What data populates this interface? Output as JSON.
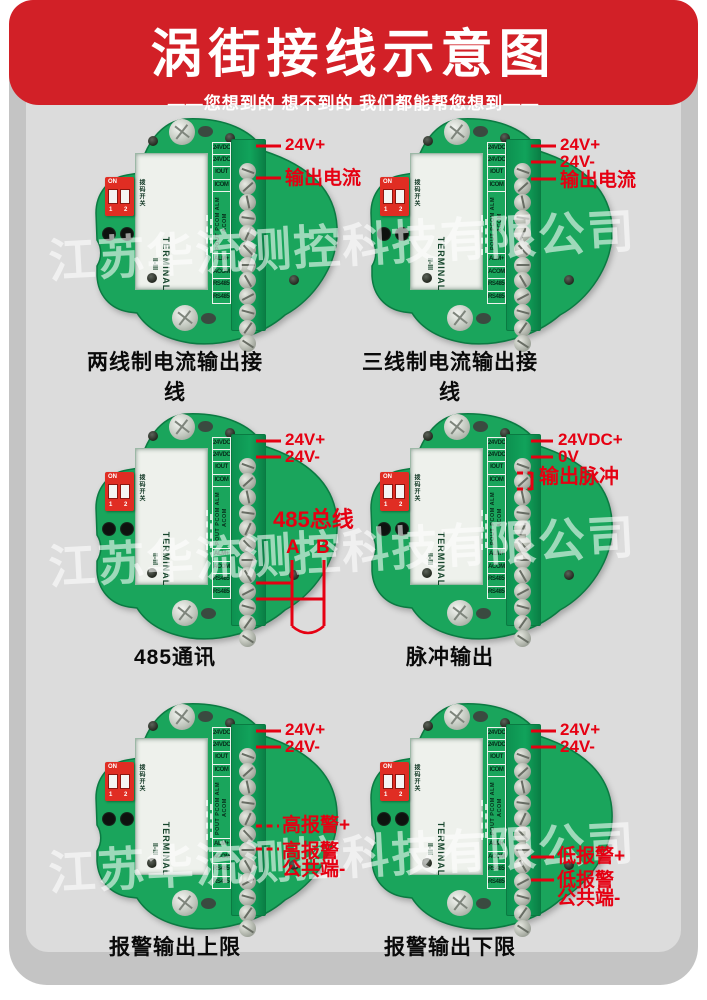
{
  "header": {
    "title": "涡街接线示意图",
    "subtitle": "——您想到的 想不到的 我们都能帮您想到——",
    "banner_color": "#d22027"
  },
  "watermark": {
    "text": "江苏华流测控科技有限公司"
  },
  "colors": {
    "board_green": "#1aa55c",
    "strip_green": "#0e9150",
    "annotation_red": "#e60012",
    "background_gray": "#dcdcdc"
  },
  "board": {
    "terminals": [
      "24VDC+",
      "24VDC-",
      "IOUT",
      "ICOM",
      "ALM+",
      "ACOM",
      "RS485+",
      "RS485-"
    ],
    "rotated_terminals": "POUT PCOM ALM ACOM",
    "silk1": "TERMINAL",
    "silk2": "II-III",
    "dip": {
      "on": "ON",
      "nums": "1 2",
      "side_label": "拨码开关"
    }
  },
  "diagrams": [
    {
      "caption": "两线制电流输出接线",
      "labels": [
        {
          "t": "24V+",
          "x": 200,
          "y": 21,
          "s": 17
        },
        {
          "t": "输出电流",
          "x": 200,
          "y": 54,
          "s": 19
        }
      ],
      "lines": [
        {
          "x1": 171,
          "y1": 31,
          "x2": 196,
          "y2": 31
        },
        {
          "x1": 171,
          "y1": 63,
          "x2": 196,
          "y2": 63
        }
      ]
    },
    {
      "caption": "三线制电流输出接线",
      "labels": [
        {
          "t": "24V+",
          "x": 200,
          "y": 21,
          "s": 17
        },
        {
          "t": "24V-",
          "x": 200,
          "y": 38,
          "s": 17
        },
        {
          "t": "输出电流",
          "x": 200,
          "y": 56,
          "s": 19
        }
      ],
      "lines": [
        {
          "x1": 171,
          "y1": 31,
          "x2": 196,
          "y2": 31
        },
        {
          "x1": 171,
          "y1": 47,
          "x2": 196,
          "y2": 47
        },
        {
          "x1": 171,
          "y1": 64,
          "x2": 196,
          "y2": 64
        }
      ]
    },
    {
      "caption": "485通讯",
      "labels": [
        {
          "t": "24V+",
          "x": 200,
          "y": 21,
          "s": 17
        },
        {
          "t": "24V-",
          "x": 200,
          "y": 38,
          "s": 17
        },
        {
          "t": "485总线",
          "x": 188,
          "y": 99,
          "s": 22
        },
        {
          "t": "A",
          "x": 201,
          "y": 128,
          "s": 19
        },
        {
          "t": "B",
          "x": 231,
          "y": 128,
          "s": 19
        }
      ],
      "lines": [
        {
          "x1": 171,
          "y1": 31,
          "x2": 196,
          "y2": 31
        },
        {
          "x1": 171,
          "y1": 47,
          "x2": 196,
          "y2": 47
        },
        {
          "x1": 171,
          "y1": 173,
          "x2": 207,
          "y2": 173
        },
        {
          "x1": 171,
          "y1": 189,
          "x2": 239,
          "y2": 189
        },
        {
          "x1": 207,
          "y1": 150,
          "x2": 207,
          "y2": 216
        },
        {
          "x1": 239,
          "y1": 150,
          "x2": 239,
          "y2": 216
        }
      ],
      "paths": [
        "M207,216 Q223,230 239,216"
      ]
    },
    {
      "caption": "脉冲输出",
      "labels": [
        {
          "t": "24VDC+",
          "x": 198,
          "y": 21,
          "s": 17
        },
        {
          "t": "0V",
          "x": 198,
          "y": 38,
          "s": 17
        },
        {
          "t": "输出脉冲",
          "x": 179,
          "y": 57,
          "s": 20
        }
      ],
      "lines": [
        {
          "x1": 171,
          "y1": 31,
          "x2": 193,
          "y2": 31
        },
        {
          "x1": 171,
          "y1": 47,
          "x2": 193,
          "y2": 47
        },
        {
          "x1": 157,
          "y1": 63,
          "x2": 172,
          "y2": 63,
          "d": 1
        },
        {
          "x1": 157,
          "y1": 79,
          "x2": 172,
          "y2": 79,
          "d": 1
        },
        {
          "x1": 172,
          "y1": 62,
          "x2": 172,
          "y2": 80
        }
      ]
    },
    {
      "caption": "报警输出上限",
      "labels": [
        {
          "t": "24V+",
          "x": 200,
          "y": 21,
          "s": 17
        },
        {
          "t": "24V-",
          "x": 200,
          "y": 38,
          "s": 17
        },
        {
          "t": "高报警+",
          "x": 197,
          "y": 116,
          "s": 19
        },
        {
          "t": "高报警",
          "x": 197,
          "y": 142,
          "s": 19
        },
        {
          "t": "公共端-",
          "x": 197,
          "y": 160,
          "s": 19
        }
      ],
      "lines": [
        {
          "x1": 171,
          "y1": 31,
          "x2": 196,
          "y2": 31
        },
        {
          "x1": 171,
          "y1": 47,
          "x2": 196,
          "y2": 47
        },
        {
          "x1": 171,
          "y1": 126,
          "x2": 194,
          "y2": 126,
          "d": 1
        },
        {
          "x1": 171,
          "y1": 149,
          "x2": 194,
          "y2": 149,
          "d": 1
        }
      ]
    },
    {
      "caption": "报警输出下限",
      "labels": [
        {
          "t": "24V+",
          "x": 200,
          "y": 21,
          "s": 17
        },
        {
          "t": "24V-",
          "x": 200,
          "y": 38,
          "s": 17
        },
        {
          "t": "低报警+",
          "x": 197,
          "y": 147,
          "s": 19
        },
        {
          "t": "低报警",
          "x": 197,
          "y": 171,
          "s": 19
        },
        {
          "t": "公共端-",
          "x": 197,
          "y": 189,
          "s": 19
        }
      ],
      "lines": [
        {
          "x1": 171,
          "y1": 31,
          "x2": 196,
          "y2": 31
        },
        {
          "x1": 171,
          "y1": 47,
          "x2": 196,
          "y2": 47
        },
        {
          "x1": 171,
          "y1": 157,
          "x2": 194,
          "y2": 157
        },
        {
          "x1": 171,
          "y1": 180,
          "x2": 194,
          "y2": 180
        }
      ]
    }
  ]
}
